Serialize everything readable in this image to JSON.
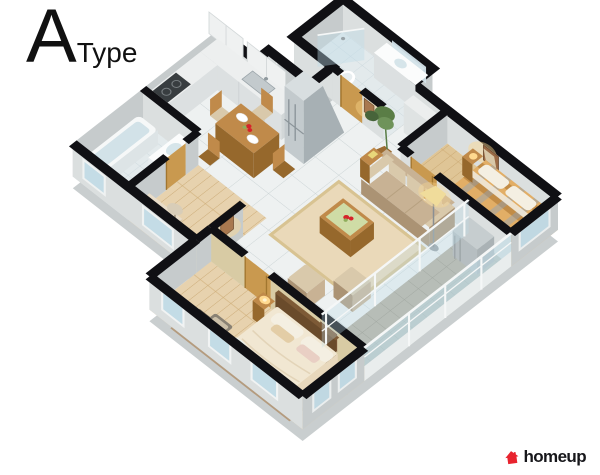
{
  "title": {
    "letter": "A",
    "word": "Type"
  },
  "brand": {
    "name": "homeup",
    "icon": "house-icon",
    "color": "#e8232e"
  },
  "palette": {
    "wallcap": "#101014",
    "wallface": "#dbdfdf",
    "wallfacedark": "#c6cbcc",
    "wallwarm": "#d8cba4",
    "slab": "#c9cecf",
    "tile": "#eef1f1",
    "woodfloor": "#dfc596",
    "masterfloor": "#e7d2ae",
    "balconyfloor": "#b7bdb7",
    "bathfloor": "#e3eaec",
    "glassfill": "#bfdce8",
    "framewhite": "#f5f7f7",
    "counter": "#edefef",
    "counterfront": "#dce0e1",
    "steel": "#c3cacd",
    "steeldark": "#a7b0b4",
    "dark": "#383d40",
    "doorwood": "#c9994f",
    "doorwooddark": "#a2762f",
    "woodfurn": "#c08a4a",
    "woodfurndark": "#96682c",
    "sofa": "#c8b294",
    "sofadark": "#ab9374",
    "cushion": "#d9c9ab",
    "rug": "#ead9b9",
    "rugmaster": "#c7b59e",
    "plaid": "#e2ae66",
    "plaidstripe": "#c28c46",
    "plaidblue": "#8fa3bb",
    "duvet": "#f1e7d2",
    "duvetshade": "#ddcbab",
    "headboard": "#6a4b2b",
    "pillow": "#f4efe2",
    "chairdark": "#5f584c",
    "green": "#5a7d46",
    "red": "#d6232b",
    "glow": "#ffd98f",
    "lamp": "#f0dc9b",
    "acgray": "#c6cdcf",
    "slate": "#a9b6c0",
    "ink": "#101014"
  }
}
